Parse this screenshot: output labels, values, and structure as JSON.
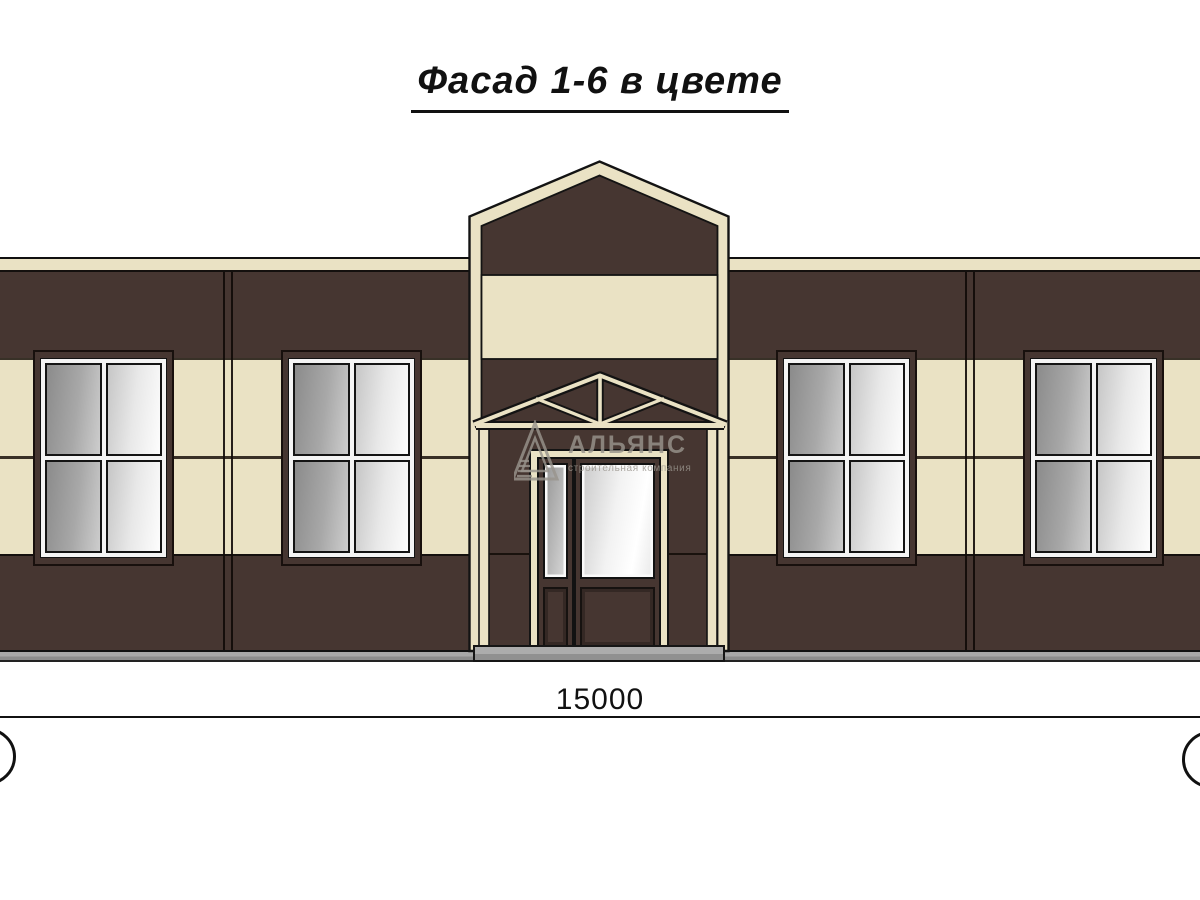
{
  "title": {
    "text": "Фасад 1-6 в цвете"
  },
  "dimension": {
    "value": "15000"
  },
  "watermark": {
    "name": "АЛЬЯНС",
    "tagline": "строительная компания"
  },
  "colors": {
    "background": "#FFFFFF",
    "wall": "#463631",
    "accent_band": "#EAE2C4",
    "plinth": "#9E9E9E",
    "line": "#141414",
    "glass_dark": "#8E8E8E",
    "glass_light": "#FBFBFB"
  }
}
